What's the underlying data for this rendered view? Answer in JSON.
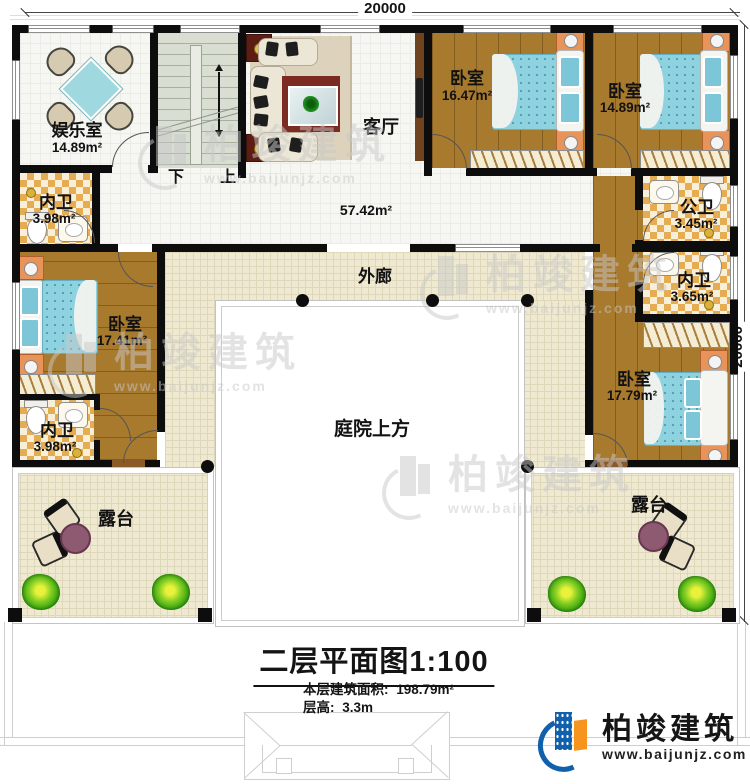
{
  "plan": {
    "dimensions": {
      "top": "20000",
      "right": "20000"
    },
    "stairs": {
      "down": "下",
      "up": "上"
    },
    "rooms": [
      {
        "id": "entertainment",
        "name": "娱乐室",
        "area": "14.89m²"
      },
      {
        "id": "living",
        "name": "客厅",
        "area": "57.42m²"
      },
      {
        "id": "bedroom-top-1",
        "name": "卧室",
        "area": "16.47m²"
      },
      {
        "id": "bedroom-top-2",
        "name": "卧室",
        "area": "14.89m²"
      },
      {
        "id": "bath-top-left",
        "name": "内卫",
        "area": "3.98m²"
      },
      {
        "id": "bath-public",
        "name": "公卫",
        "area": "3.45m²"
      },
      {
        "id": "bath-right",
        "name": "内卫",
        "area": "3.65m²"
      },
      {
        "id": "bedroom-left",
        "name": "卧室",
        "area": "17.41m²"
      },
      {
        "id": "bath-bottom-left",
        "name": "内卫",
        "area": "3.98m²"
      },
      {
        "id": "bedroom-right",
        "name": "卧室",
        "area": "17.79m²"
      }
    ],
    "zones": {
      "corridor": "外廊",
      "courtyard": "庭院上方",
      "terrace_left": "露台",
      "terrace_right": "露台"
    }
  },
  "title": {
    "main": "二层平面图",
    "scale": "1:100",
    "area_label": "本层建筑面积:",
    "area_value": "198.79m²",
    "height_label": "层高:",
    "height_value": "3.3m"
  },
  "branding": {
    "logo_name": "柏竣建筑",
    "logo_url": "www.baijunjz.com",
    "watermark_name": "柏竣建筑",
    "watermark_url": "www.baijunjz.com"
  },
  "colors": {
    "wall": "#0d0d0d",
    "wood_floor": "#a87a2e",
    "bed": "#8ed2e0",
    "corridor_floor": "#efe9d1",
    "bath_checker": "#e5ac52",
    "stair": "#d8dfd2",
    "logo_blue": "#1160ac",
    "logo_orange": "#f7941d",
    "terrace_table": "#8d5a71"
  }
}
